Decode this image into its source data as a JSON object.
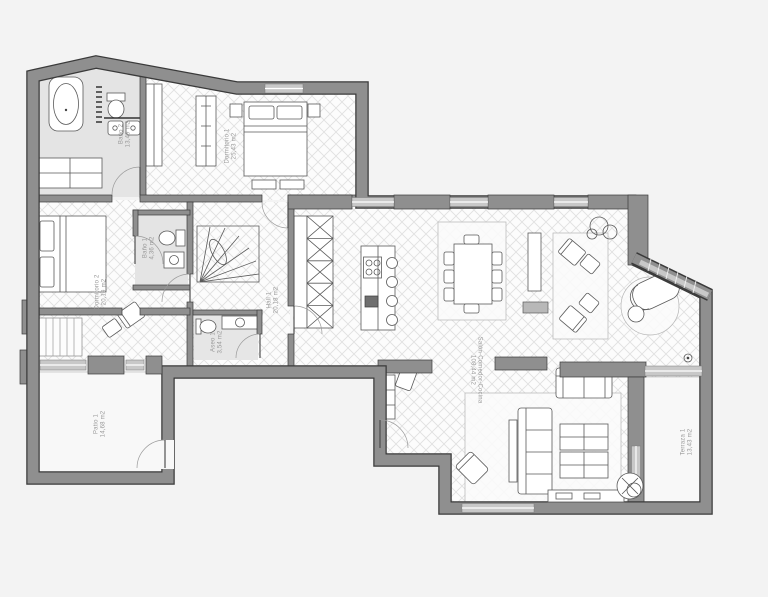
{
  "plan": {
    "type": "apartment-floor-plan",
    "rooms": [
      {
        "id": "bano2",
        "name": "Baño 2",
        "area": "13,49 m2"
      },
      {
        "id": "dorm1",
        "name": "Dormitorio 1",
        "area": "25,43 m2"
      },
      {
        "id": "dorm2",
        "name": "Dormitorio 2",
        "area": "20,19 m2"
      },
      {
        "id": "bano1",
        "name": "Baño 1",
        "area": "4,36 m2"
      },
      {
        "id": "hall1",
        "name": "Hall 1",
        "area": "20,18 m2"
      },
      {
        "id": "aseo1",
        "name": "Aseo 1",
        "area": "3,54 m2"
      },
      {
        "id": "patio1",
        "name": "Patio 1",
        "area": "14,68 m2"
      },
      {
        "id": "salon",
        "name": "Salón-Comedor-Cocina",
        "area": "108,44 m2"
      },
      {
        "id": "terraza",
        "name": "Terraza 1",
        "area": "13,43 m2"
      }
    ],
    "colors": {
      "wall_fill": "#8f8f8f",
      "wall_edge": "#3a3a3a",
      "bath_floor": "#e4e4e4",
      "parquet_line": "#e0e0e0",
      "window_glass": "#c8c8c8",
      "furniture_line": "#5a5a5a",
      "label_text": "#999999",
      "background": "#f3f3f3"
    }
  }
}
